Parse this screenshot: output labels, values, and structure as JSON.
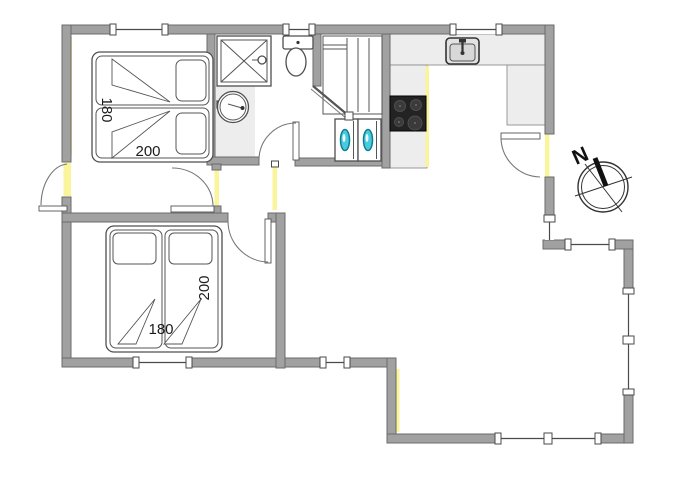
{
  "compass": {
    "north_label": "N"
  },
  "bedroom1": {
    "bed_width_label": "180",
    "bed_length_label": "200"
  },
  "bedroom2": {
    "bed_width_label": "180",
    "bed_length_label": "200"
  },
  "fixtures": {
    "shower": "shower",
    "toilet": "toilet",
    "washbasin": "washbasin",
    "wardrobe": "wardrobe-shelves",
    "washer_left": "washing-machine",
    "washer_right": "washing-machine",
    "kitchen_sink": "kitchen-sink",
    "stove": "stove-hob",
    "bed1": "double-bed",
    "bed2": "double-bed",
    "compass": "compass-rose"
  },
  "colors": {
    "wall_fill": "#a1a1a1",
    "wall_edge": "#6b6b6b",
    "highlight_yellow": "#faf49b",
    "counter_fill": "#ededed",
    "stove_black": "#232323",
    "appliance_door_cyan": "#49cbdd",
    "line_dark": "#4f4f4f"
  }
}
